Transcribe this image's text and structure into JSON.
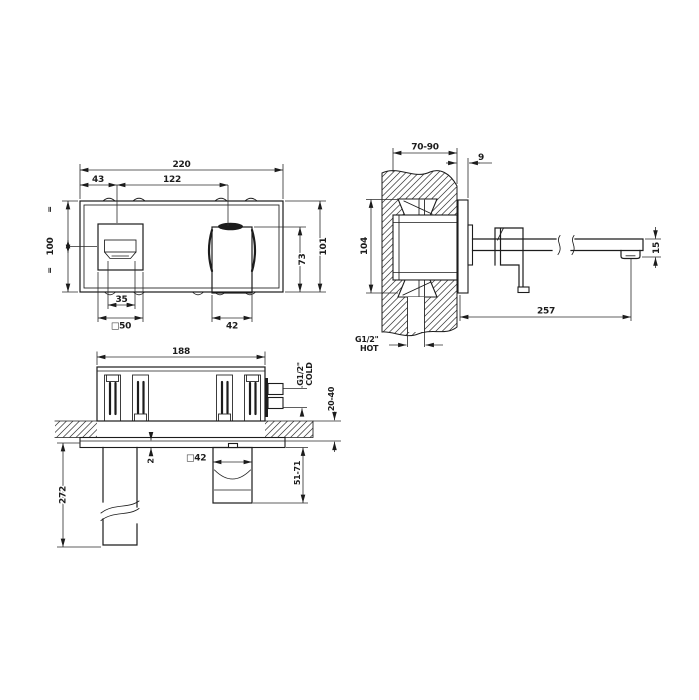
{
  "drawing": {
    "background": "#ffffff",
    "line_color": "#1c1c1c",
    "views": {
      "front": {
        "dims": {
          "overall_width": "220",
          "control_offset_left": "43",
          "controls_spacing": "122",
          "plate_height": "100",
          "body_height": "101",
          "handle_height": "73",
          "control_inner_width": "35",
          "control_plate_size": "□50",
          "handle_width": "42",
          "equal_mark": "="
        }
      },
      "side": {
        "dims": {
          "wall_depth_range": "70-90",
          "trim_thickness": "9",
          "rough_body_height": "104",
          "spout_reach": "257",
          "spout_tip_height": "15"
        },
        "labels": {
          "hot_connection": "G1/2\"",
          "hot": "HOT"
        }
      },
      "plan": {
        "dims": {
          "body_width": "188",
          "plate_gap": "2",
          "spout_length": "272",
          "handle_section_size": "□42",
          "handle_projection_range": "51-71",
          "finished_wall_range": "20-40"
        },
        "labels": {
          "cold_connection": "G1/2\"",
          "cold": "COLD"
        }
      }
    }
  }
}
